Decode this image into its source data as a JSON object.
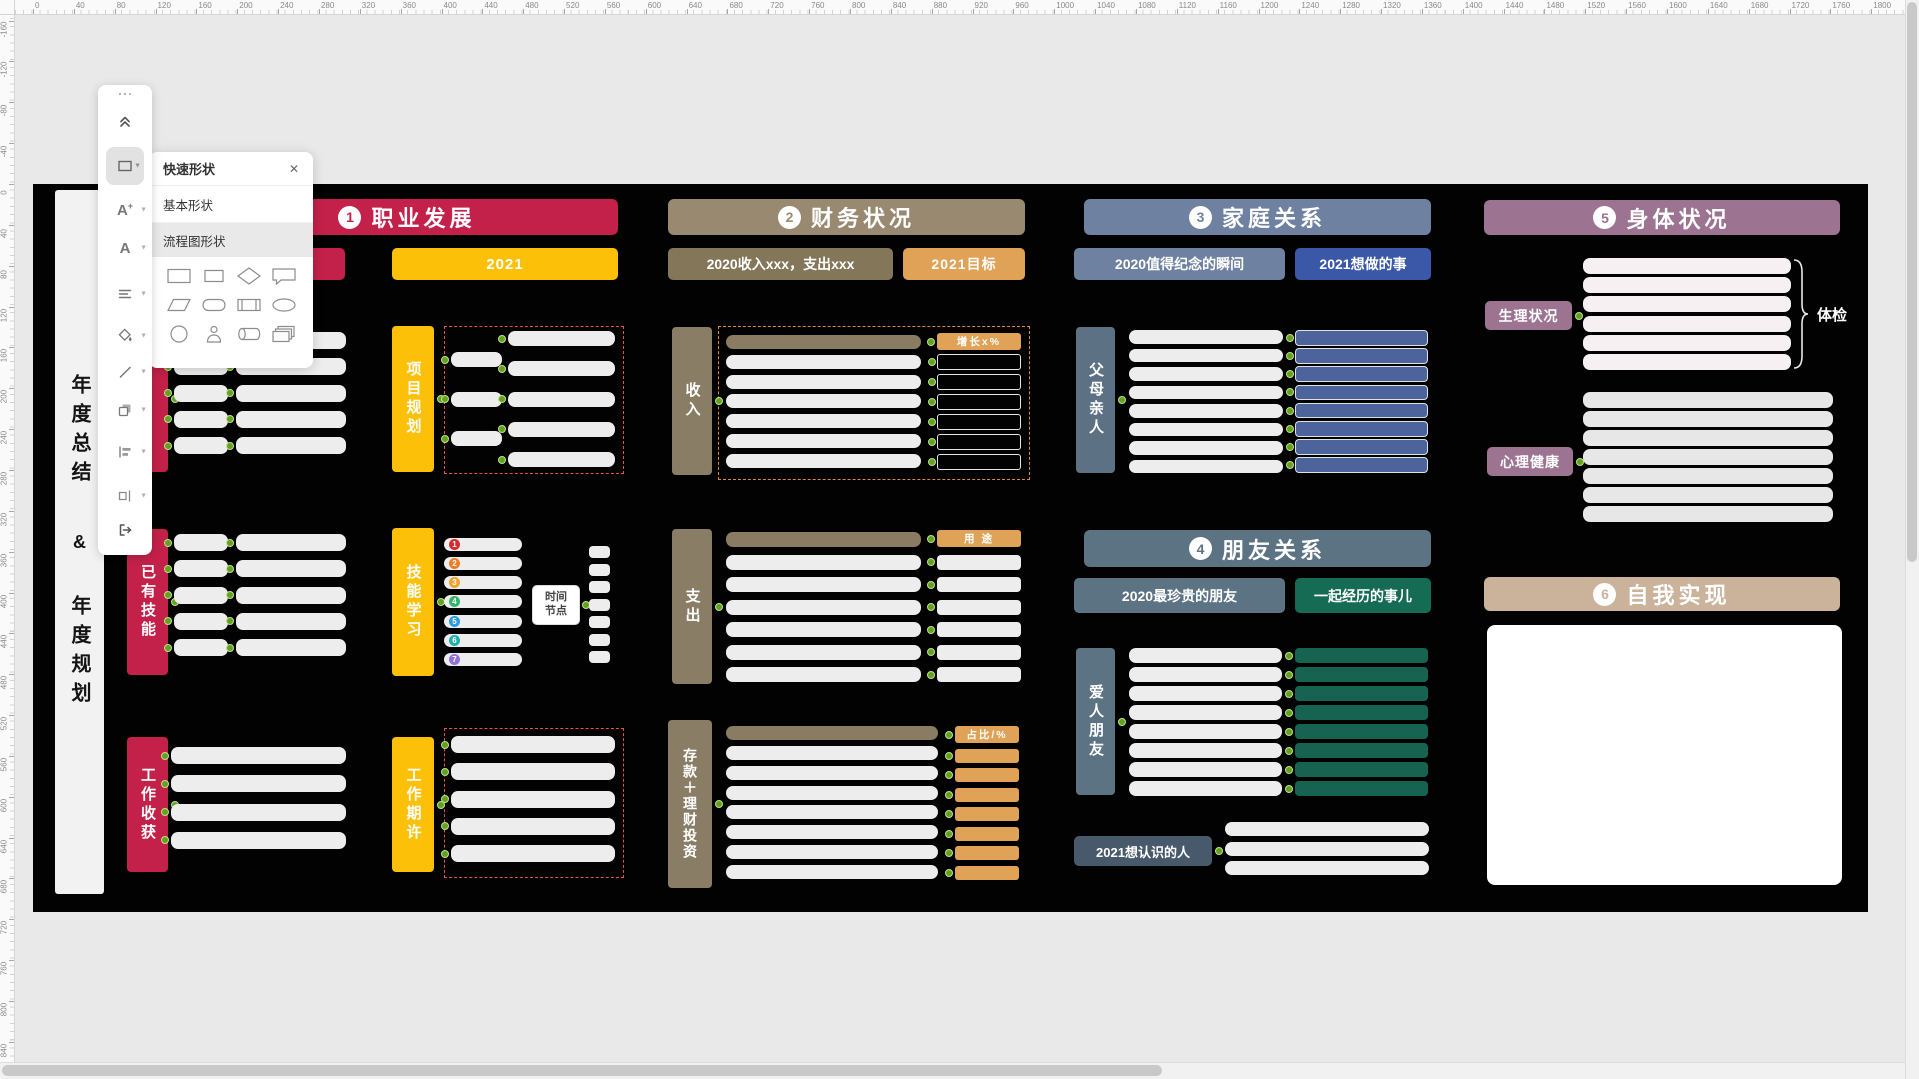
{
  "window": {
    "bg": "#E9E9E9",
    "canvas_bg": "#020202"
  },
  "rulers": {
    "step": 40,
    "px_per_step": 40.85,
    "origin_x": 33,
    "origin_y": 184,
    "top_min": 0,
    "top_max": 1840,
    "left_min": -160,
    "left_max": 840
  },
  "toolbar": {
    "tools": [
      "more-handle",
      "collapse",
      "shape-tool",
      "insert-text-tool",
      "font-tool",
      "text-align-tool",
      "fill-tool",
      "line-tool",
      "copy-style-tool",
      "align-tool",
      "distribute-tool",
      "export-tool"
    ]
  },
  "shape_panel": {
    "title": "快速形状",
    "close": "✕",
    "tabs": [
      "基本形状",
      "流程图形状"
    ],
    "shapes": [
      "rectangle",
      "rectangle2",
      "diamond",
      "callout",
      "parallelogram",
      "stadium",
      "predefined-process",
      "ellipse",
      "circle",
      "actor",
      "cylinder",
      "stack"
    ]
  },
  "note": {
    "line1": "年度总结",
    "amp": "&",
    "line2": "年度规划"
  },
  "colors": {
    "dot": "#63A21E",
    "row_white": "#EDEDED"
  },
  "sections": {
    "career": {
      "num": "1",
      "title": "职业发展",
      "color": "#C32149",
      "accent": "#FDC008",
      "box2020": "",
      "box2021": "2021",
      "g1": {
        "label2020": "",
        "label2021": "项目规划",
        "a": 5,
        "b": 5,
        "ra": 3,
        "rb": 5
      },
      "g2": {
        "label2020": "已有技能",
        "label2021": "技能学习",
        "a": 5,
        "b": 5,
        "small": 7,
        "mid": "时间节点",
        "badges": [
          {
            "n": "1",
            "color": "#D92B2B"
          },
          {
            "n": "2",
            "color": "#EF7D23"
          },
          {
            "n": "3",
            "color": "#F0A32F"
          },
          {
            "n": "4",
            "color": "#37B26C"
          },
          {
            "n": "5",
            "color": "#2E9BE5"
          },
          {
            "n": "6",
            "color": "#1FB0A8"
          },
          {
            "n": "7",
            "color": "#8F72D2"
          }
        ]
      },
      "g3": {
        "label2020": "工作收获",
        "label2021": "工作期许",
        "left": 4,
        "right": 5
      }
    },
    "finance": {
      "num": "2",
      "title": "财务状况",
      "color": "#9A8971",
      "box2020": "2020收入xxx，支出xxx",
      "box2020_color": "#837659",
      "box2021": "2021目标",
      "orange": "#DFA256",
      "bar": "#8A7C63",
      "label_bg": "#8A7D66",
      "income": {
        "label": "收入",
        "tag": "增长x%",
        "rows": 7
      },
      "expense": {
        "label": "支出",
        "tag": "用 途",
        "rows": 7
      },
      "savings": {
        "label": "存款＋理财投资",
        "tag": "占比/%",
        "rows": 8
      }
    },
    "family": {
      "num": "3",
      "title": "家庭关系",
      "color": "#6E81A0",
      "box2020": "2020值得纪念的瞬间",
      "box2021": "2021想做的事",
      "box2021_color": "#3A57A8",
      "label": "父母亲人",
      "label_bg": "#5C7284",
      "row_color": "#4C639B",
      "rows": 8
    },
    "friends": {
      "num": "4",
      "title": "朋友关系",
      "color": "#5C7384",
      "box2020": "2020最珍贵的朋友",
      "box2021": "一起经历的事儿",
      "box2021_color": "#156B54",
      "label": "爱人朋友",
      "row_color": "#156350",
      "rows": 8,
      "meet": {
        "label": "2021想认识的人",
        "color": "#47596B",
        "rows": 3
      }
    },
    "health": {
      "num": "5",
      "title": "身体状况",
      "color": "#9C7390",
      "physical": {
        "label": "生理状况",
        "rows": 6,
        "row_color": "#F7F0F2",
        "bracket": "体检"
      },
      "mental": {
        "label": "心理健康",
        "rows": 7,
        "row_color": "#E7E7E7"
      }
    },
    "self": {
      "num": "6",
      "title": "自我实现",
      "color": "#CBB29B"
    }
  }
}
